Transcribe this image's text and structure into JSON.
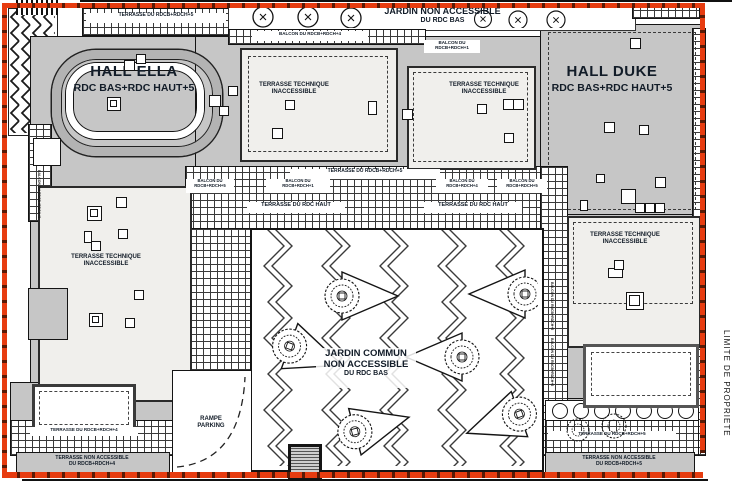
{
  "plan": {
    "property_line": {
      "label": "LIMITE DE PROPRIETE",
      "color": "#e73c10"
    },
    "colors": {
      "roof": "#c6c6c6",
      "technical_terrace": "#f0efec",
      "linework": "#141414",
      "text": "#121c28"
    },
    "halls": {
      "ella": {
        "name": "HALL ELLA",
        "levels": "RDC BAS+RDC HAUT+5"
      },
      "duke": {
        "name": "HALL DUKE",
        "levels": "RDC BAS+RDC HAUT+5"
      }
    },
    "garden_top": {
      "line1": "JARDIN NON ACCESSIBLE",
      "line2": "DU RDC BAS"
    },
    "garden_central": {
      "line1": "JARDIN COMMUN",
      "line2": "NON ACCESSIBLE",
      "line3": "DU RDC BAS"
    },
    "technical_terrace": {
      "line1": "TERRASSE TECHNIQUE",
      "line2": "INACCESSIBLE"
    },
    "terraces": {
      "top_strip": "TERRASSE DU RDCB+RDCH+5",
      "mid_strip": "TERRASSE DU RDCB+RDCH+5",
      "rdc_haut": "TERRASSE DU RDC HAUT",
      "bottom_left": "TERRASSE DU RDCB+RDCH+4",
      "bottom_right": "TERRASSE DU RDCB+RDCH+5",
      "non_accessible_left": {
        "line1": "TERRASSE NON ACCESSIBLE",
        "line2": "DU RDCB+RDCH+4"
      },
      "non_accessible_right": {
        "line1": "TERRASSE NON ACCESSIBLE",
        "line2": "DU RDCB+RDCH+5"
      }
    },
    "balconies": {
      "top": "BALCON DU RDCB+RDCH+4",
      "upper_right": {
        "line1": "BALCON DU",
        "line2": "RDCB+RDCH+1"
      },
      "left": {
        "line1": "BALCON DU",
        "line2": "RDCB+RDCH+5"
      },
      "center": {
        "line1": "BALCON DU",
        "line2": "RDCB+RDCH+1"
      },
      "right_a": {
        "line1": "BALCON DU",
        "line2": "RDCB+RDCH+4"
      },
      "right_b": {
        "line1": "BALCON DU",
        "line2": "RDCB+RDCH+5"
      },
      "edge": "BALCON DU RDCB+RDCH+5"
    },
    "ramp": {
      "line1": "RAMPE",
      "line2": "PARKING"
    }
  }
}
